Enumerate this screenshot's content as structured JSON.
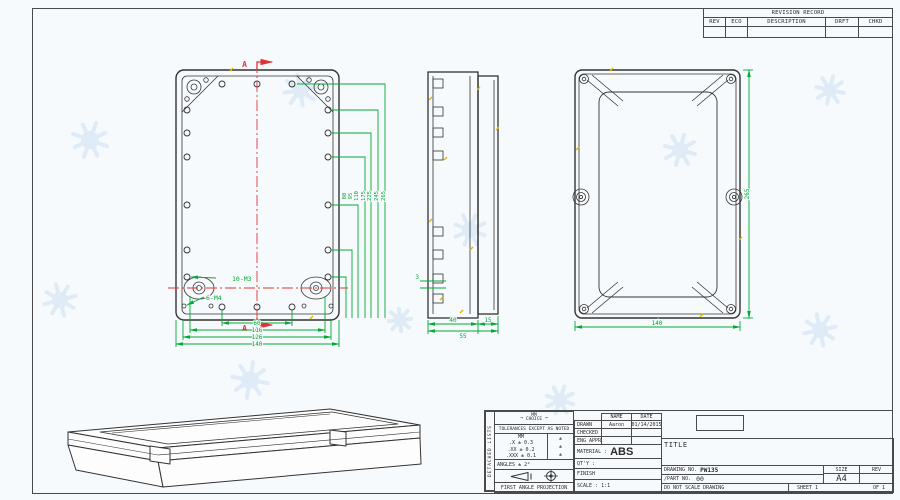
{
  "colors": {
    "linework": "#333333",
    "dimension_green": "#00ab32",
    "centerline_red": "#e03434",
    "tick_yellow": "#ddb900",
    "watermark_blue": "#d7e6f4"
  },
  "revision_table": {
    "title": "REVISION RECORD",
    "columns": [
      "REV",
      "ECO",
      "DESCRIPTION",
      "DRFT",
      "CHKD"
    ]
  },
  "front_view": {
    "section_marker": "A",
    "thread_labels": {
      "small": "10-M3",
      "corner": "6-M4"
    },
    "bottom_dims": [
      "60",
      "116",
      "126",
      "140"
    ],
    "side_dims": [
      "80",
      "95",
      "110",
      "175",
      "225",
      "245",
      "265"
    ]
  },
  "side_view": {
    "wall_dim": "3",
    "body_dim": "40",
    "lid_dim": "15",
    "total_dim": "55"
  },
  "rear_view": {
    "height_dim": "265",
    "width_dim": "140"
  },
  "title_block": {
    "detached_lists": "DETACHED LISTS",
    "units_label": "MM",
    "units_sub": "CHOICE",
    "tolerance_heading": "TOLERANCES EXCEPT AS NOTED",
    "tolerance_unit_header": "MM",
    "tolerance_rows": [
      {
        "mm": ".X ± 0.3",
        "alt": "±"
      },
      {
        "mm": ".XX ± 0.2",
        "alt": "±"
      },
      {
        "mm": ".XXX ± 0.1",
        "alt": "±"
      }
    ],
    "angles": "ANGLES ± 2°",
    "projection": "FIRST ANGLE PROJECTION",
    "name_header": "NAME",
    "date_header": "DATE",
    "drawn_label": "DRAWN",
    "drawn_name": "Aaron",
    "drawn_date": "01/14/2015",
    "checked_label": "CHECKED",
    "eng_appr_label": "ENG APPR",
    "material_label": "MATERIAL :",
    "material_value": "ABS",
    "qty_label": "QT'Y :",
    "finish_label": "FINISH",
    "scale_label": "SCALE : 1:1",
    "title_label": "TITLE",
    "drawing_no_label": "DRAWING NO.",
    "drawing_no_value": "PW135",
    "part_no_label": "/PART  NO.",
    "part_no_value": "00",
    "size_label": "SIZE",
    "size_value": "A4",
    "rev_label": "REV",
    "do_not_scale": "DO NOT SCALE DRAWING",
    "sheet_label": "SHEET 1",
    "of_label": "OF 1"
  }
}
